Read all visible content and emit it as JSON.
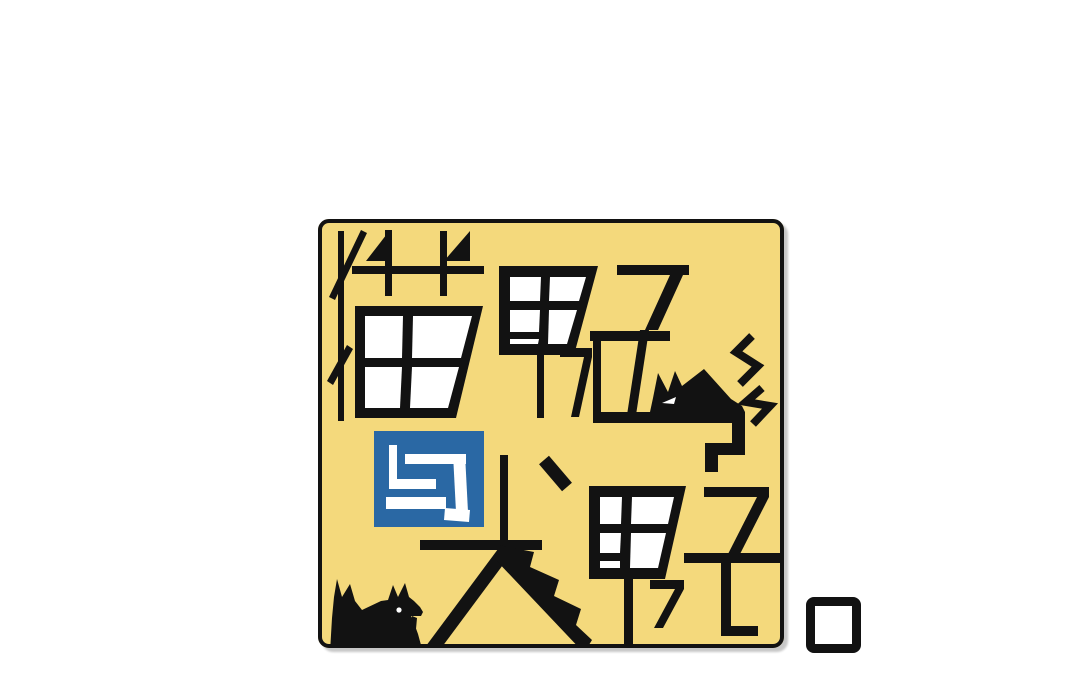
{
  "logo": {
    "title": "猫男子与犬男子",
    "segments": {
      "top_row": "猫男子",
      "connector": "与",
      "bottom_row": "犬男子"
    },
    "icons": {
      "cat": "angry-cat-silhouette",
      "cat_sparks": "lightning-anger-sparks",
      "dog": "dog-silhouette-tongue-out",
      "period": "hollow-square-period-mark"
    },
    "colors": {
      "page_bg": "#ffffff",
      "logo_bg": "#f4d97c",
      "ink": "#121212",
      "paper": "#ffffff",
      "connector_bg": "#2a68a4",
      "connector_fg": "#ffffff"
    }
  }
}
